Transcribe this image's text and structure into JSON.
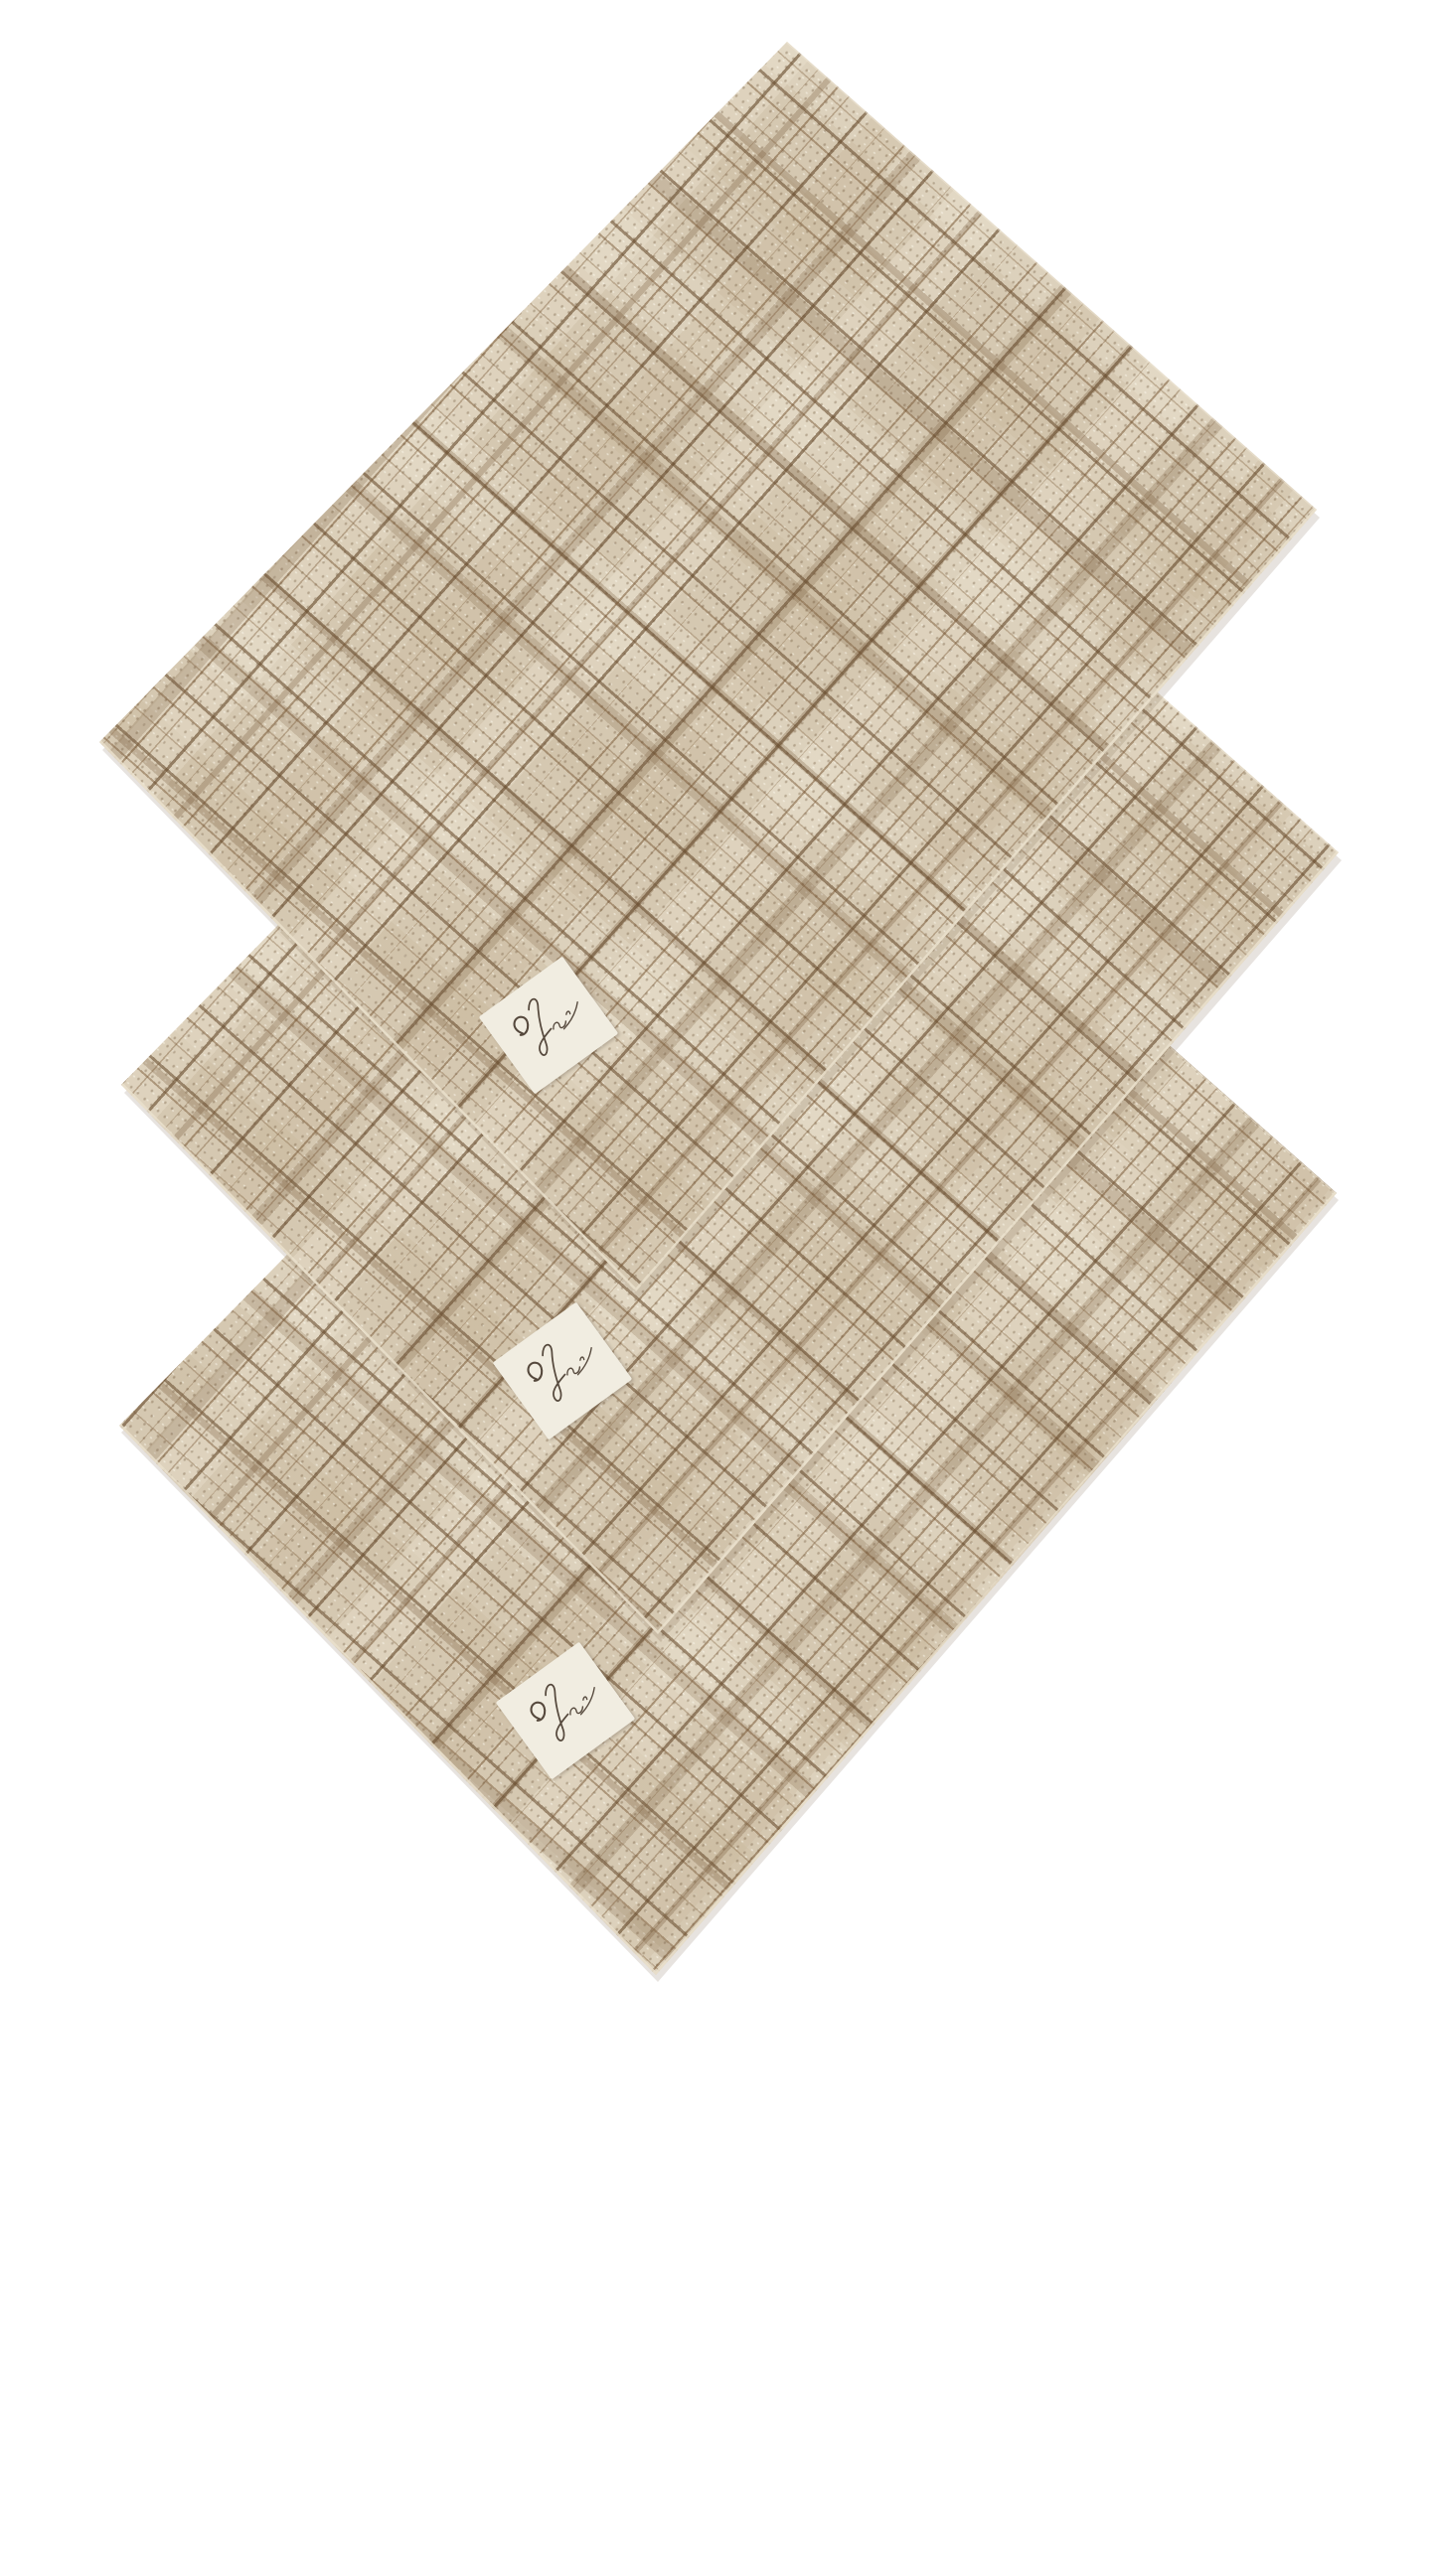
{
  "scene": {
    "description": "Product photograph of a set of 3 matching woven plaid handkerchief napkins, arranged overlapping in a diagonal cascade on a plain white background",
    "item_count": 3,
    "background_color": "#ffffff"
  },
  "fabric": {
    "pattern": "irregular brown crosshatch plaid on cream woven cloth",
    "base_color": "#d5c8b1",
    "light_patch_color": "#e6ddca",
    "thread_color": "#7a5a38",
    "dark_thread_color": "#684c2e",
    "edge_highlight_color": "#eae1cd",
    "weave_angle_deg": 41.5
  },
  "napkins": [
    {
      "name": "napkin-top",
      "title": "Top napkin, rotated square, label near bottom corner",
      "vertices": {
        "top": [
          792,
          42
        ],
        "right": [
          1325,
          513
        ],
        "bottom": [
          640,
          1300
        ],
        "left": [
          100,
          747
        ]
      }
    },
    {
      "name": "napkin-middle",
      "title": "Middle napkin, partially covered by top napkin",
      "vertices": {
        "top": [
          814,
          387
        ],
        "right": [
          1347,
          858
        ],
        "bottom": [
          662,
          1645
        ],
        "left": [
          122,
          1092
        ]
      }
    },
    {
      "name": "napkin-bottom",
      "title": "Bottom napkin, partially covered by middle napkin",
      "vertices": {
        "top": [
          812,
          730
        ],
        "right": [
          1345,
          1201
        ],
        "bottom": [
          660,
          1988
        ],
        "left": [
          120,
          1435
        ]
      }
    }
  ],
  "brand_tag": {
    "background_color": "#f1ede1",
    "ink_color": "#55483c",
    "content": "illegible cursive brand signature",
    "count": 3,
    "title": "Small white fabric brand tag with handwritten-style cursive signature"
  }
}
